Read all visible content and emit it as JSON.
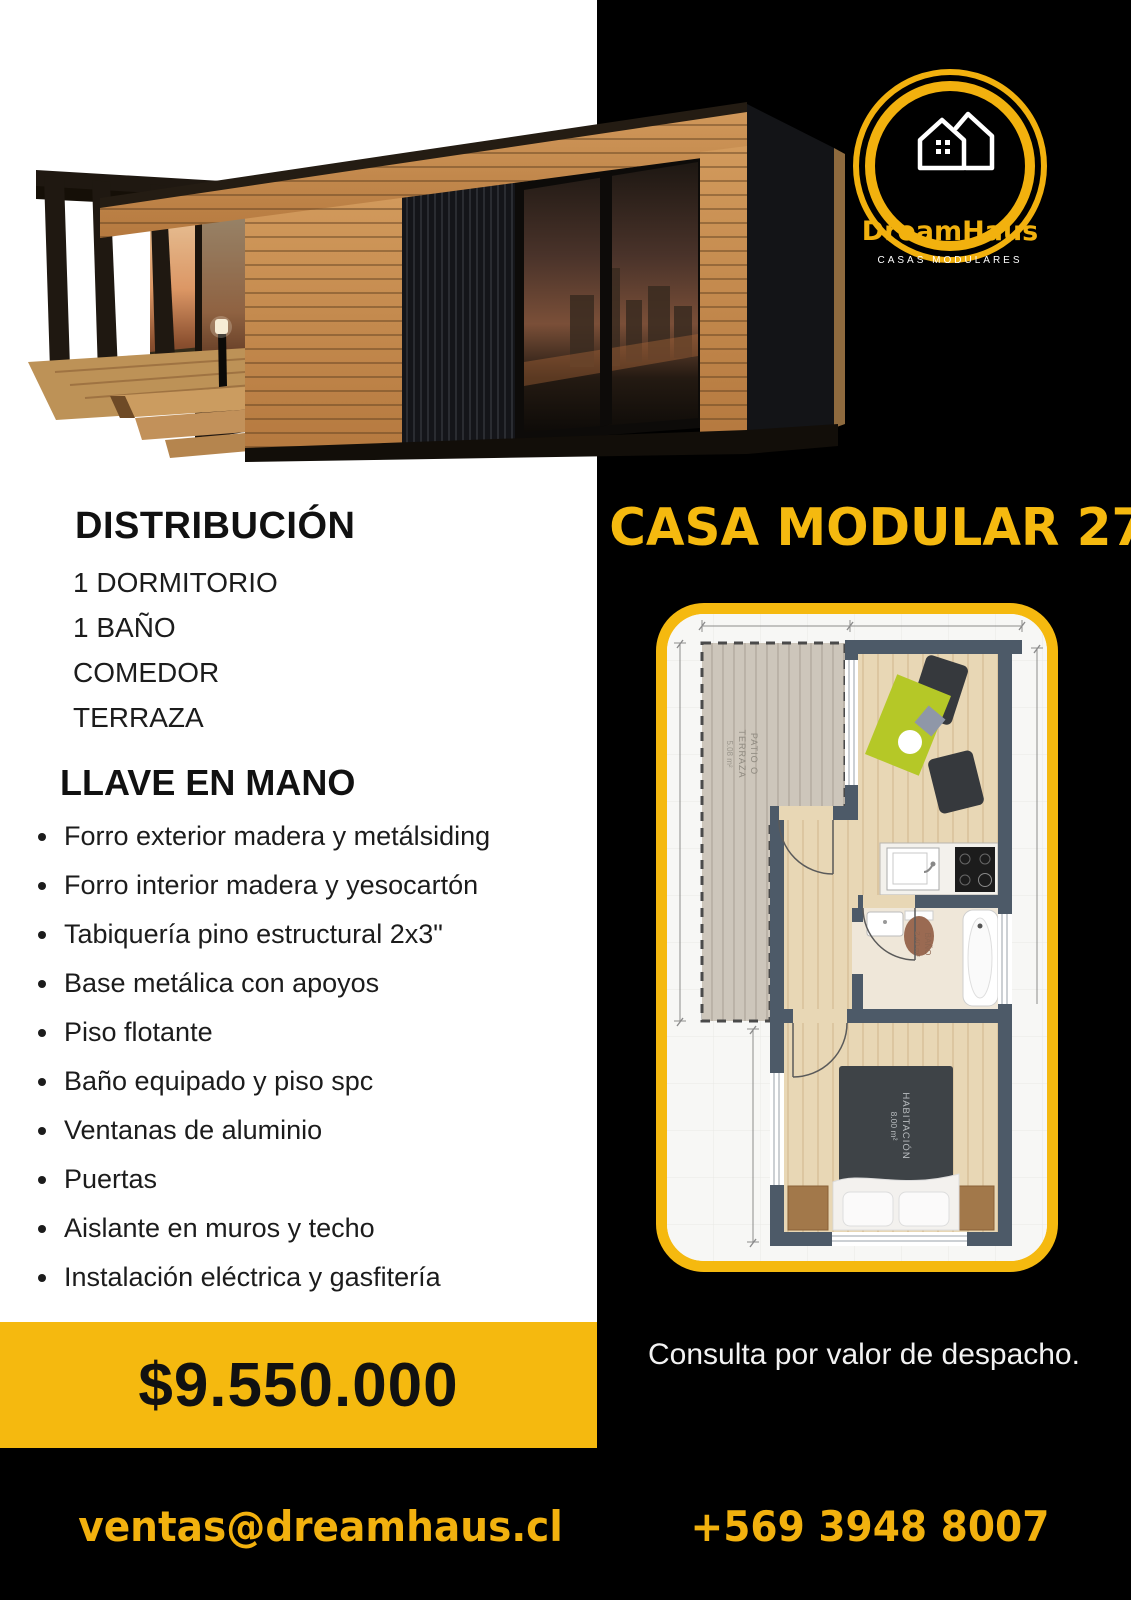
{
  "brand": {
    "name": "DreamHaus",
    "tagline": "CASAS MODULARES"
  },
  "product": {
    "title": "CASA MODULAR 27M"
  },
  "distribution": {
    "title": "DISTRIBUCIÓN",
    "items": [
      "1 DORMITORIO",
      "1 BAÑO",
      "COMEDOR",
      "TERRAZA"
    ]
  },
  "turnkey": {
    "title": "LLAVE EN MANO",
    "features": [
      "Forro exterior madera y metálsiding",
      "Forro interior madera y yesocartón",
      "Tabiquería pino estructural 2x3\"",
      "Base metálica con apoyos",
      "Piso flotante",
      "Baño equipado y piso spc",
      "Ventanas de aluminio",
      "Puertas",
      "Aislante en muros y techo",
      "Instalación eléctrica y gasfitería"
    ]
  },
  "price": {
    "amount": "$9.550.000"
  },
  "shipping": {
    "note": "Consulta por valor de despacho."
  },
  "contact": {
    "email": "ventas@dreamhaus.cl",
    "phone": "+569 3948 8007"
  },
  "floorplan": {
    "terrace_label_1": "PATIO O",
    "terrace_label_2": "TERRAZA",
    "terrace_area": "5.08 m²",
    "bath_label": "BAÑO",
    "bath_area": "2.40 m²",
    "bedroom_label": "HABITACIÓN",
    "bedroom_area": "8.00 m²"
  },
  "colors": {
    "accent_yellow": "#F5B90F",
    "logo_yellow": "#F2B10E",
    "background_black": "#000000",
    "plan_wall": "#4d5a68",
    "plan_table_green": "#b5c827",
    "text_dark": "#1c1c1c"
  }
}
